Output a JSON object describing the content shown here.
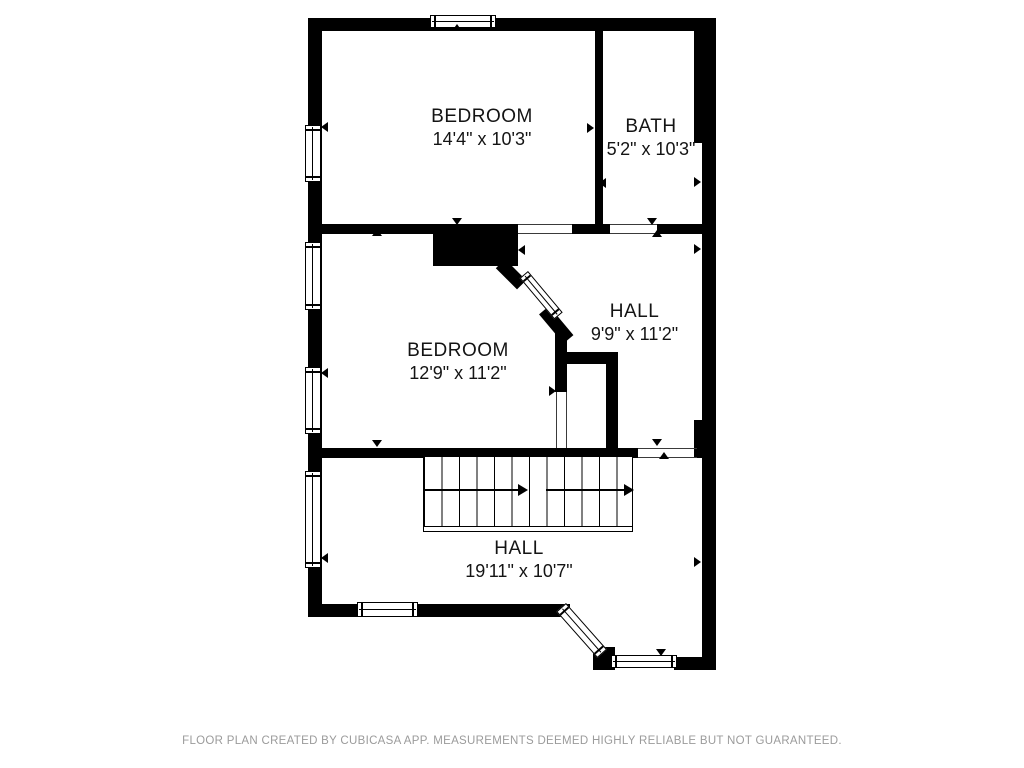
{
  "plan": {
    "rooms": [
      {
        "id": "bedroom-top",
        "name": "BEDROOM",
        "dims": "14'4\" x 10'3\""
      },
      {
        "id": "bath",
        "name": "BATH",
        "dims": "5'2\" x 10'3\""
      },
      {
        "id": "hall-middle",
        "name": "HALL",
        "dims": "9'9\" x 11'2\""
      },
      {
        "id": "bedroom-middle",
        "name": "BEDROOM",
        "dims": "12'9\" x 11'2\""
      },
      {
        "id": "hall-lower",
        "name": "HALL",
        "dims": "19'11\" x 10'7\""
      }
    ],
    "features": [
      "staircase-with-direction-arrows",
      "windows",
      "door-openings",
      "bay-corner-window"
    ]
  },
  "footer": {
    "disclaimer": "FLOOR PLAN CREATED BY CUBICASA APP. MEASUREMENTS DEEMED HIGHLY RELIABLE BUT NOT GUARANTEED."
  },
  "colors": {
    "wall": "#000000",
    "background": "#ffffff",
    "footer_text": "#9b9b9b"
  }
}
